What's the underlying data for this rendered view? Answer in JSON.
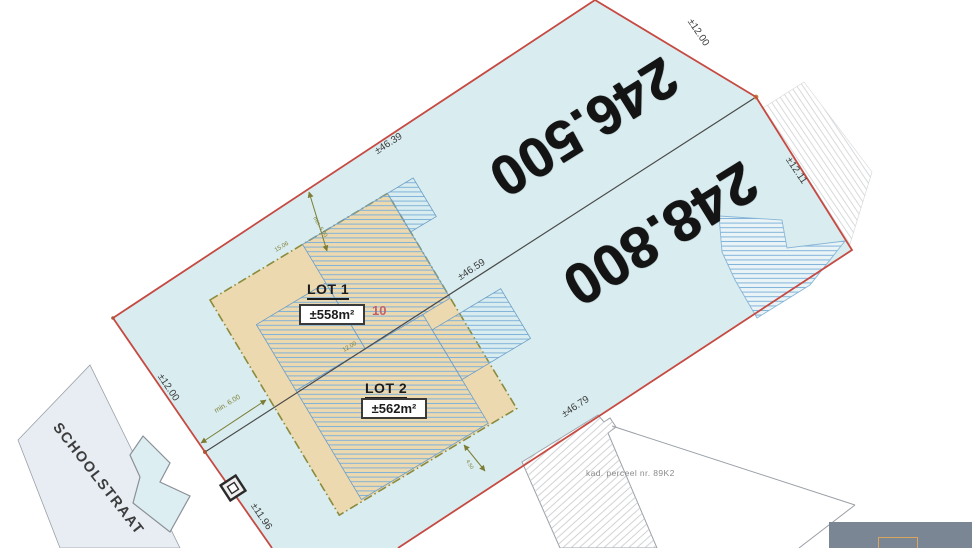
{
  "street": {
    "name": "SCHOOLSTRAAT"
  },
  "cadastral": {
    "neighbor_parcel": "kad. perceel nr. 89K2"
  },
  "handwritten": {
    "price_top": "246.500",
    "price_bottom": "248.800"
  },
  "lots": {
    "lot1": {
      "label": "LOT 1",
      "area": "±558m²",
      "house_number": "10"
    },
    "lot2": {
      "label": "LOT 2",
      "area": "±562m²"
    }
  },
  "dims": {
    "edge_nw": "±46.39",
    "edge_ne": "±12.00",
    "edge_e": "±12.11",
    "divider": "±46.59",
    "edge_se": "±46.79",
    "edge_sw": "±11.96",
    "edge_w": "±12.00"
  },
  "setbacks": {
    "front": "min. 6.00",
    "side": "min. 5.00",
    "rear": "4.50",
    "env_width": "15.06",
    "env_depth": "12.00"
  },
  "colors": {
    "parcel_fill": "#d9edf0",
    "boundary_red": "#c64a42",
    "envelope_fill": "#ecd9b0",
    "envelope_border": "#8b8b3d",
    "building_hatch_blue": "#7fb2d9",
    "neighbor_hatch_gray": "#c3c7cb",
    "divider_gray": "#4a4a4a",
    "handwriting": "#141414",
    "inset_bg": "#7a8694"
  }
}
